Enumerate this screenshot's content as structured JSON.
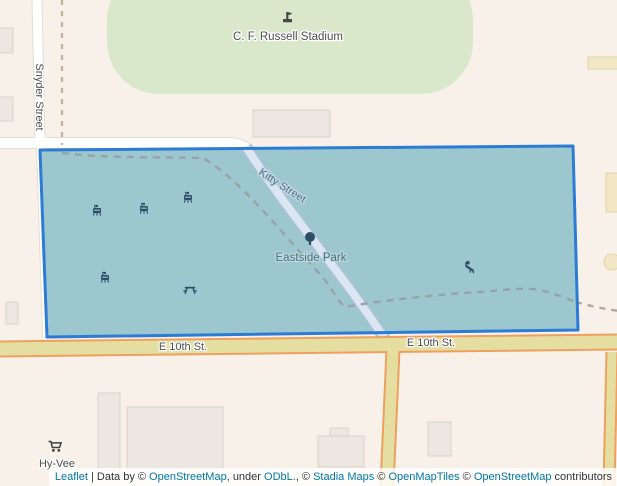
{
  "map": {
    "place_labels": {
      "stadium": "C. F. Russell Stadium",
      "park": "Eastside Park",
      "store": "Hy-Vee"
    },
    "street_labels": {
      "snyder": "Snyder Street",
      "kitty": "Kitty Street",
      "e10th_west": "E 10th St.",
      "e10th_east": "E 10th St."
    },
    "icons": {
      "stadium": "stadium-icon",
      "park_tree": "tree-icon",
      "bbq_grill": "bbq-grill-icon",
      "picnic_table": "picnic-table-icon",
      "playground": "playground-slide-icon",
      "store_cart": "shopping-cart-icon"
    },
    "colors": {
      "background": "#f8f1e9",
      "park_green": "#d9e8cb",
      "polygon_fill": "#9cc7cf",
      "polygon_stroke": "#2c7cd5",
      "major_road_fill": "#e5dea1",
      "major_road_casing": "#ef9f5e",
      "link_blue": "#0078a8"
    }
  },
  "attribution": {
    "leaflet": "Leaflet",
    "sep1": " | Data by © ",
    "osm1": "OpenStreetMap",
    "sep2": ", under ",
    "odbl": "ODbL.",
    "sep3": ", © ",
    "stadia": "Stadia Maps",
    "sep4": " © ",
    "openmaptiles": "OpenMapTiles",
    "sep5": " © ",
    "osm2": "OpenStreetMap",
    "sep6": " contributors"
  }
}
